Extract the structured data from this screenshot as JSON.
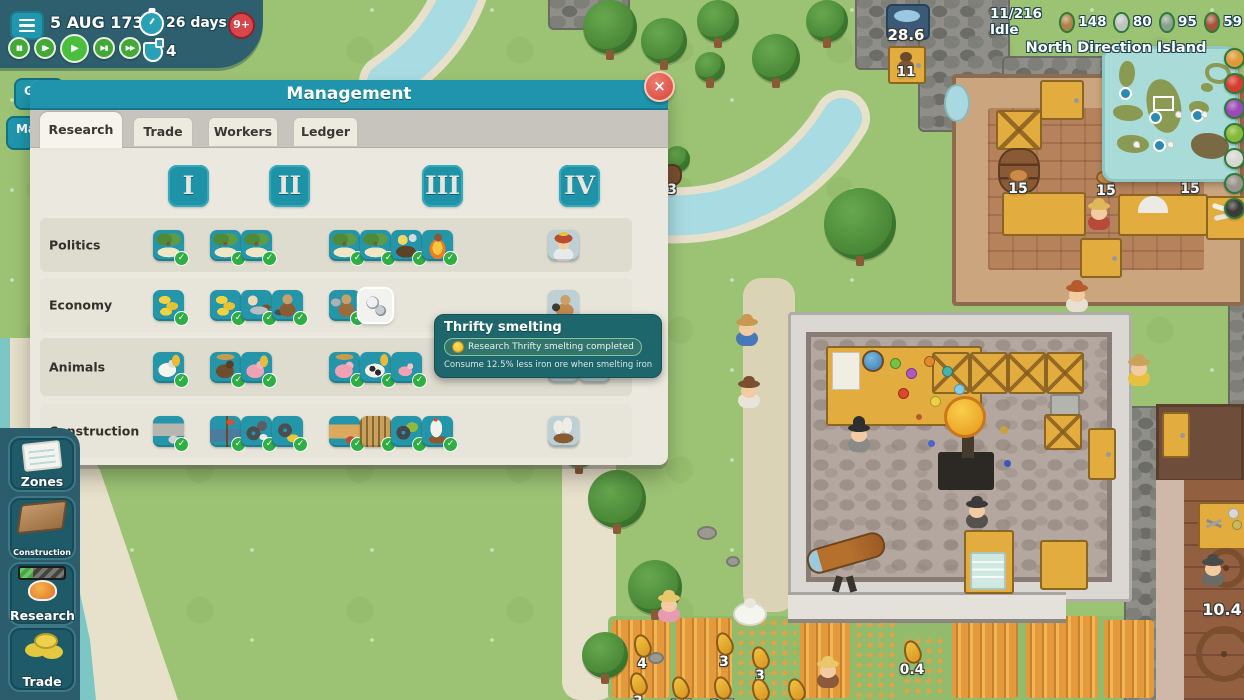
{
  "topbar": {
    "date": "5 AUG 1733",
    "timer": "26 days",
    "alert_badge": "9+",
    "potions": "4",
    "speed_controls": [
      {
        "name": "pause-button",
        "glyph": "▮▮"
      },
      {
        "name": "speed-slow-button",
        "glyph": "▮▶"
      },
      {
        "name": "speed-normal-button",
        "glyph": "▶",
        "active": true
      },
      {
        "name": "speed-fast-button",
        "glyph": "▶▮"
      },
      {
        "name": "speed-fastest-button",
        "glyph": "▶▶"
      }
    ]
  },
  "status": {
    "idle": "11/216 Idle",
    "resources": [
      {
        "name": "wood",
        "value": "148",
        "color": "#b08046"
      },
      {
        "name": "stone",
        "value": "80",
        "color": "#c0c4c0"
      },
      {
        "name": "pickaxe",
        "value": "95",
        "color": "#8aa08e"
      },
      {
        "name": "bricks",
        "value": "59",
        "color": "#a8523a"
      }
    ],
    "island": "North Direction Island"
  },
  "minimap": {
    "legend": [
      {
        "name": "carrot",
        "color": "#e09a3a"
      },
      {
        "name": "tomato",
        "color": "#d83c2e"
      },
      {
        "name": "grapes",
        "color": "#9a4ab8"
      },
      {
        "name": "cabbage",
        "color": "#88b83a"
      },
      {
        "name": "stone",
        "color": "#d8d8d0"
      },
      {
        "name": "rock",
        "color": "#98948c"
      },
      {
        "name": "coal",
        "color": "#3c3a36"
      }
    ]
  },
  "sidebar": {
    "partial": [
      "G",
      "Ma"
    ],
    "items": [
      {
        "label": "Zones",
        "icon": "zones-map"
      },
      {
        "label": "Construction",
        "icon": "wood-floor"
      },
      {
        "label": "Research",
        "icon": "amber-progress"
      },
      {
        "label": "Trade",
        "icon": "coins"
      }
    ]
  },
  "dialog": {
    "title": "Management",
    "close": "×",
    "tabs": [
      {
        "label": "Research",
        "active": true
      },
      {
        "label": "Trade"
      },
      {
        "label": "Workers"
      },
      {
        "label": "Ledger"
      }
    ],
    "tiers": [
      "I",
      "II",
      "III",
      "IV"
    ],
    "rows": [
      {
        "label": "Politics",
        "groups": [
          [
            {
              "icon": "island",
              "state": "done"
            }
          ],
          [
            {
              "icon": "island",
              "state": "done"
            },
            {
              "icon": "island",
              "state": "done"
            }
          ],
          [
            {
              "icon": "island",
              "state": "done"
            },
            {
              "icon": "island",
              "state": "done"
            },
            {
              "icon": "lamp",
              "state": "done"
            },
            {
              "icon": "fire",
              "state": "done"
            }
          ],
          [
            {
              "icon": "princess",
              "state": "locked"
            }
          ]
        ]
      },
      {
        "label": "Economy",
        "groups": [
          [
            {
              "icon": "coins",
              "state": "done"
            }
          ],
          [
            {
              "icon": "coins",
              "state": "done"
            },
            {
              "icon": "saw",
              "state": "done"
            },
            {
              "icon": "porter",
              "state": "done"
            }
          ],
          [
            {
              "icon": "hammerman",
              "state": "done"
            },
            {
              "icon": "ore",
              "state": "hover"
            }
          ],
          [
            {
              "icon": "trader",
              "state": "locked"
            }
          ]
        ]
      },
      {
        "label": "Animals",
        "groups": [
          [
            {
              "icon": "sheep",
              "state": "done"
            }
          ],
          [
            {
              "icon": "boar",
              "state": "done"
            },
            {
              "icon": "pig",
              "state": "done"
            }
          ],
          [
            {
              "icon": "pigfence",
              "state": "done"
            },
            {
              "icon": "cow",
              "state": "done"
            },
            {
              "icon": "piglet",
              "state": "done"
            }
          ],
          [
            {
              "icon": "loom",
              "state": "locked"
            },
            {
              "icon": "goat",
              "state": "locked"
            }
          ]
        ]
      },
      {
        "label": "Construction",
        "groups": [
          [
            {
              "icon": "stonewall",
              "state": "done"
            }
          ],
          [
            {
              "icon": "flaghouse",
              "state": "done"
            },
            {
              "icon": "gearhammer",
              "state": "done"
            },
            {
              "icon": "geargold",
              "state": "done"
            }
          ],
          [
            {
              "icon": "woodwall",
              "state": "done"
            },
            {
              "icon": "toolrack",
              "state": "done"
            },
            {
              "icon": "geargreen",
              "state": "done"
            },
            {
              "icon": "boat",
              "state": "done"
            }
          ],
          [
            {
              "icon": "ship",
              "state": "locked"
            }
          ]
        ]
      }
    ]
  },
  "tooltip": {
    "title": "Thrifty smelting",
    "status": "Research Thrifty smelting completed",
    "effect": "Consume 12.5% less iron ore when smelting iron"
  },
  "world": {
    "well_level": "28.6",
    "house_count": "11",
    "bench_counts": [
      "15",
      "15",
      "15"
    ],
    "animal_count": "3",
    "spinner_rate": "10.4",
    "corn_counts": [
      "4",
      "3",
      "3",
      "0.4",
      "3",
      "4.5",
      "3.7",
      "3",
      "3"
    ]
  }
}
